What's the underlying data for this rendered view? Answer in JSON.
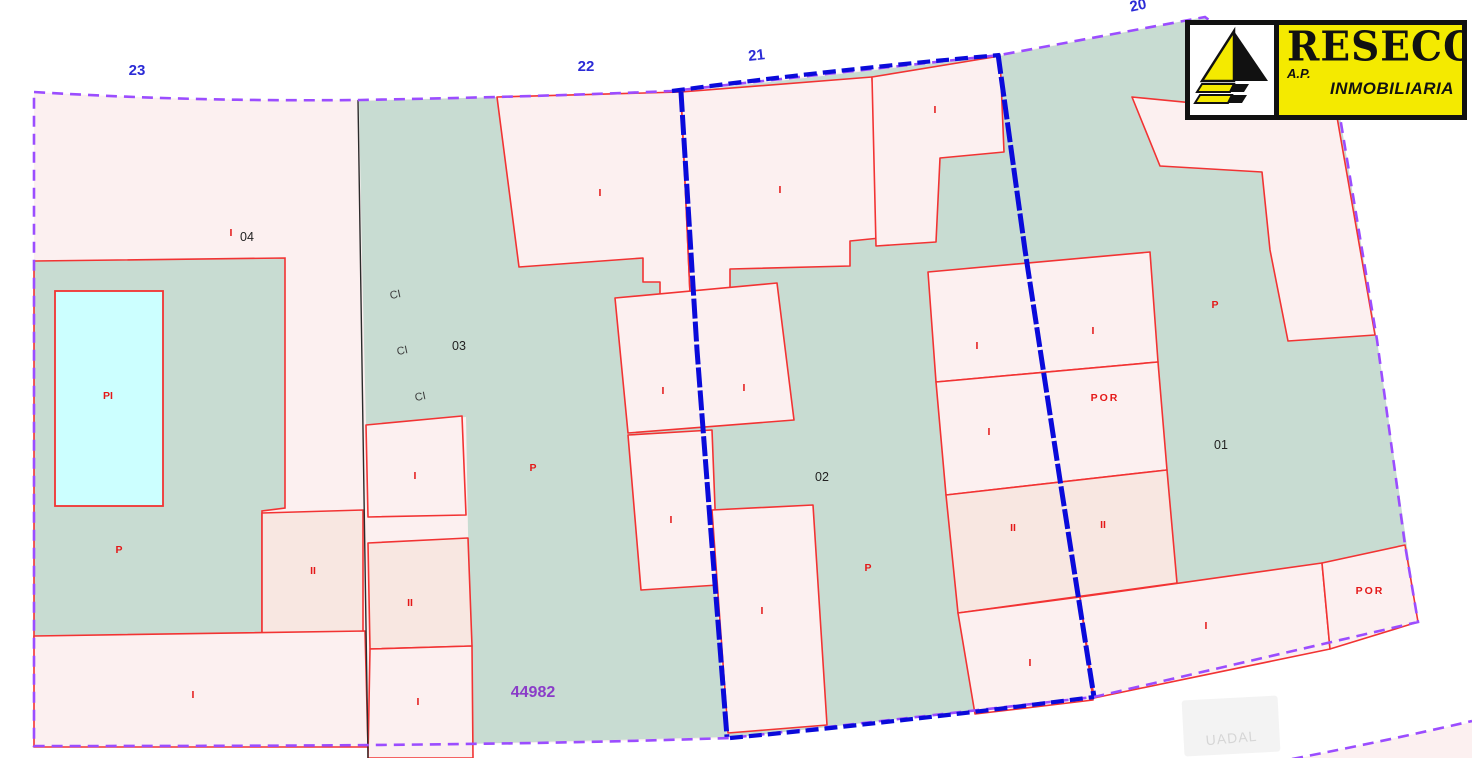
{
  "title": "Cadastral parcel map",
  "logo": {
    "name": "RESECO",
    "line1": "A.P.",
    "line2": "INMOBILIARIA"
  },
  "map": {
    "reference_number": "44982",
    "watermark": "UADAL",
    "colors": {
      "land": "#c8dcd2",
      "building": "#fcf0f0",
      "building_dark": "#f8e7e1",
      "pool": "#ccffff",
      "red_line": "#f23333",
      "red_text": "#e41818",
      "purple_boundary": "#9b4dff",
      "blue_road": "#0a0ada",
      "street_blue": "#2b2bd6",
      "ref_purple": "#8a3cc8",
      "black_line": "#2b2b2b",
      "parcel_text": "#222222",
      "logo_yellow": "#f4ea00"
    },
    "labels": [
      {
        "t": "23",
        "k": "street",
        "x": 137,
        "y": 75
      },
      {
        "t": "22",
        "k": "street",
        "x": 586,
        "y": 71
      },
      {
        "t": "21",
        "k": "street",
        "x": 757,
        "y": 60,
        "rot": -6
      },
      {
        "t": "20",
        "k": "street",
        "x": 1139,
        "y": 10,
        "rot": -12
      },
      {
        "t": "04",
        "k": "parcel",
        "x": 247,
        "y": 241
      },
      {
        "t": "03",
        "k": "parcel",
        "x": 459,
        "y": 350
      },
      {
        "t": "02",
        "k": "parcel",
        "x": 822,
        "y": 481
      },
      {
        "t": "01",
        "k": "parcel",
        "x": 1221,
        "y": 449
      },
      {
        "t": "CI",
        "k": "ci",
        "x": 396,
        "y": 298,
        "rot": -12
      },
      {
        "t": "CI",
        "k": "ci",
        "x": 403,
        "y": 354,
        "rot": -12
      },
      {
        "t": "CI",
        "k": "ci",
        "x": 421,
        "y": 400,
        "rot": -12
      },
      {
        "t": "44982",
        "k": "ref",
        "x": 533,
        "y": 697
      },
      {
        "t": "I",
        "k": "con",
        "x": 231,
        "y": 236
      },
      {
        "t": "I",
        "k": "con",
        "x": 600,
        "y": 196
      },
      {
        "t": "I",
        "k": "con",
        "x": 780,
        "y": 193
      },
      {
        "t": "I",
        "k": "con",
        "x": 935,
        "y": 113
      },
      {
        "t": "P",
        "k": "con",
        "x": 533,
        "y": 471
      },
      {
        "t": "I",
        "k": "con",
        "x": 415,
        "y": 479
      },
      {
        "t": "II",
        "k": "con",
        "x": 313,
        "y": 574
      },
      {
        "t": "II",
        "k": "con",
        "x": 410,
        "y": 606
      },
      {
        "t": "I",
        "k": "con",
        "x": 193,
        "y": 698
      },
      {
        "t": "I",
        "k": "con",
        "x": 418,
        "y": 705
      },
      {
        "t": "I",
        "k": "con",
        "x": 663,
        "y": 394
      },
      {
        "t": "I",
        "k": "con",
        "x": 744,
        "y": 391
      },
      {
        "t": "I",
        "k": "con",
        "x": 671,
        "y": 523
      },
      {
        "t": "I",
        "k": "con",
        "x": 762,
        "y": 614
      },
      {
        "t": "P",
        "k": "con",
        "x": 868,
        "y": 571
      },
      {
        "t": "P",
        "k": "con",
        "x": 119,
        "y": 553
      },
      {
        "t": "PI",
        "k": "con",
        "x": 108,
        "y": 399
      },
      {
        "t": "I",
        "k": "con",
        "x": 977,
        "y": 349
      },
      {
        "t": "I",
        "k": "con",
        "x": 1093,
        "y": 334
      },
      {
        "t": "I",
        "k": "con",
        "x": 989,
        "y": 435
      },
      {
        "t": "POR",
        "k": "con",
        "x": 1105,
        "y": 401
      },
      {
        "t": "II",
        "k": "con",
        "x": 1013,
        "y": 531
      },
      {
        "t": "II",
        "k": "con",
        "x": 1103,
        "y": 528
      },
      {
        "t": "I",
        "k": "con",
        "x": 1030,
        "y": 666
      },
      {
        "t": "I",
        "k": "con",
        "x": 1206,
        "y": 629
      },
      {
        "t": "POR",
        "k": "con",
        "x": 1370,
        "y": 594
      },
      {
        "t": "P",
        "k": "con",
        "x": 1215,
        "y": 308
      }
    ]
  }
}
